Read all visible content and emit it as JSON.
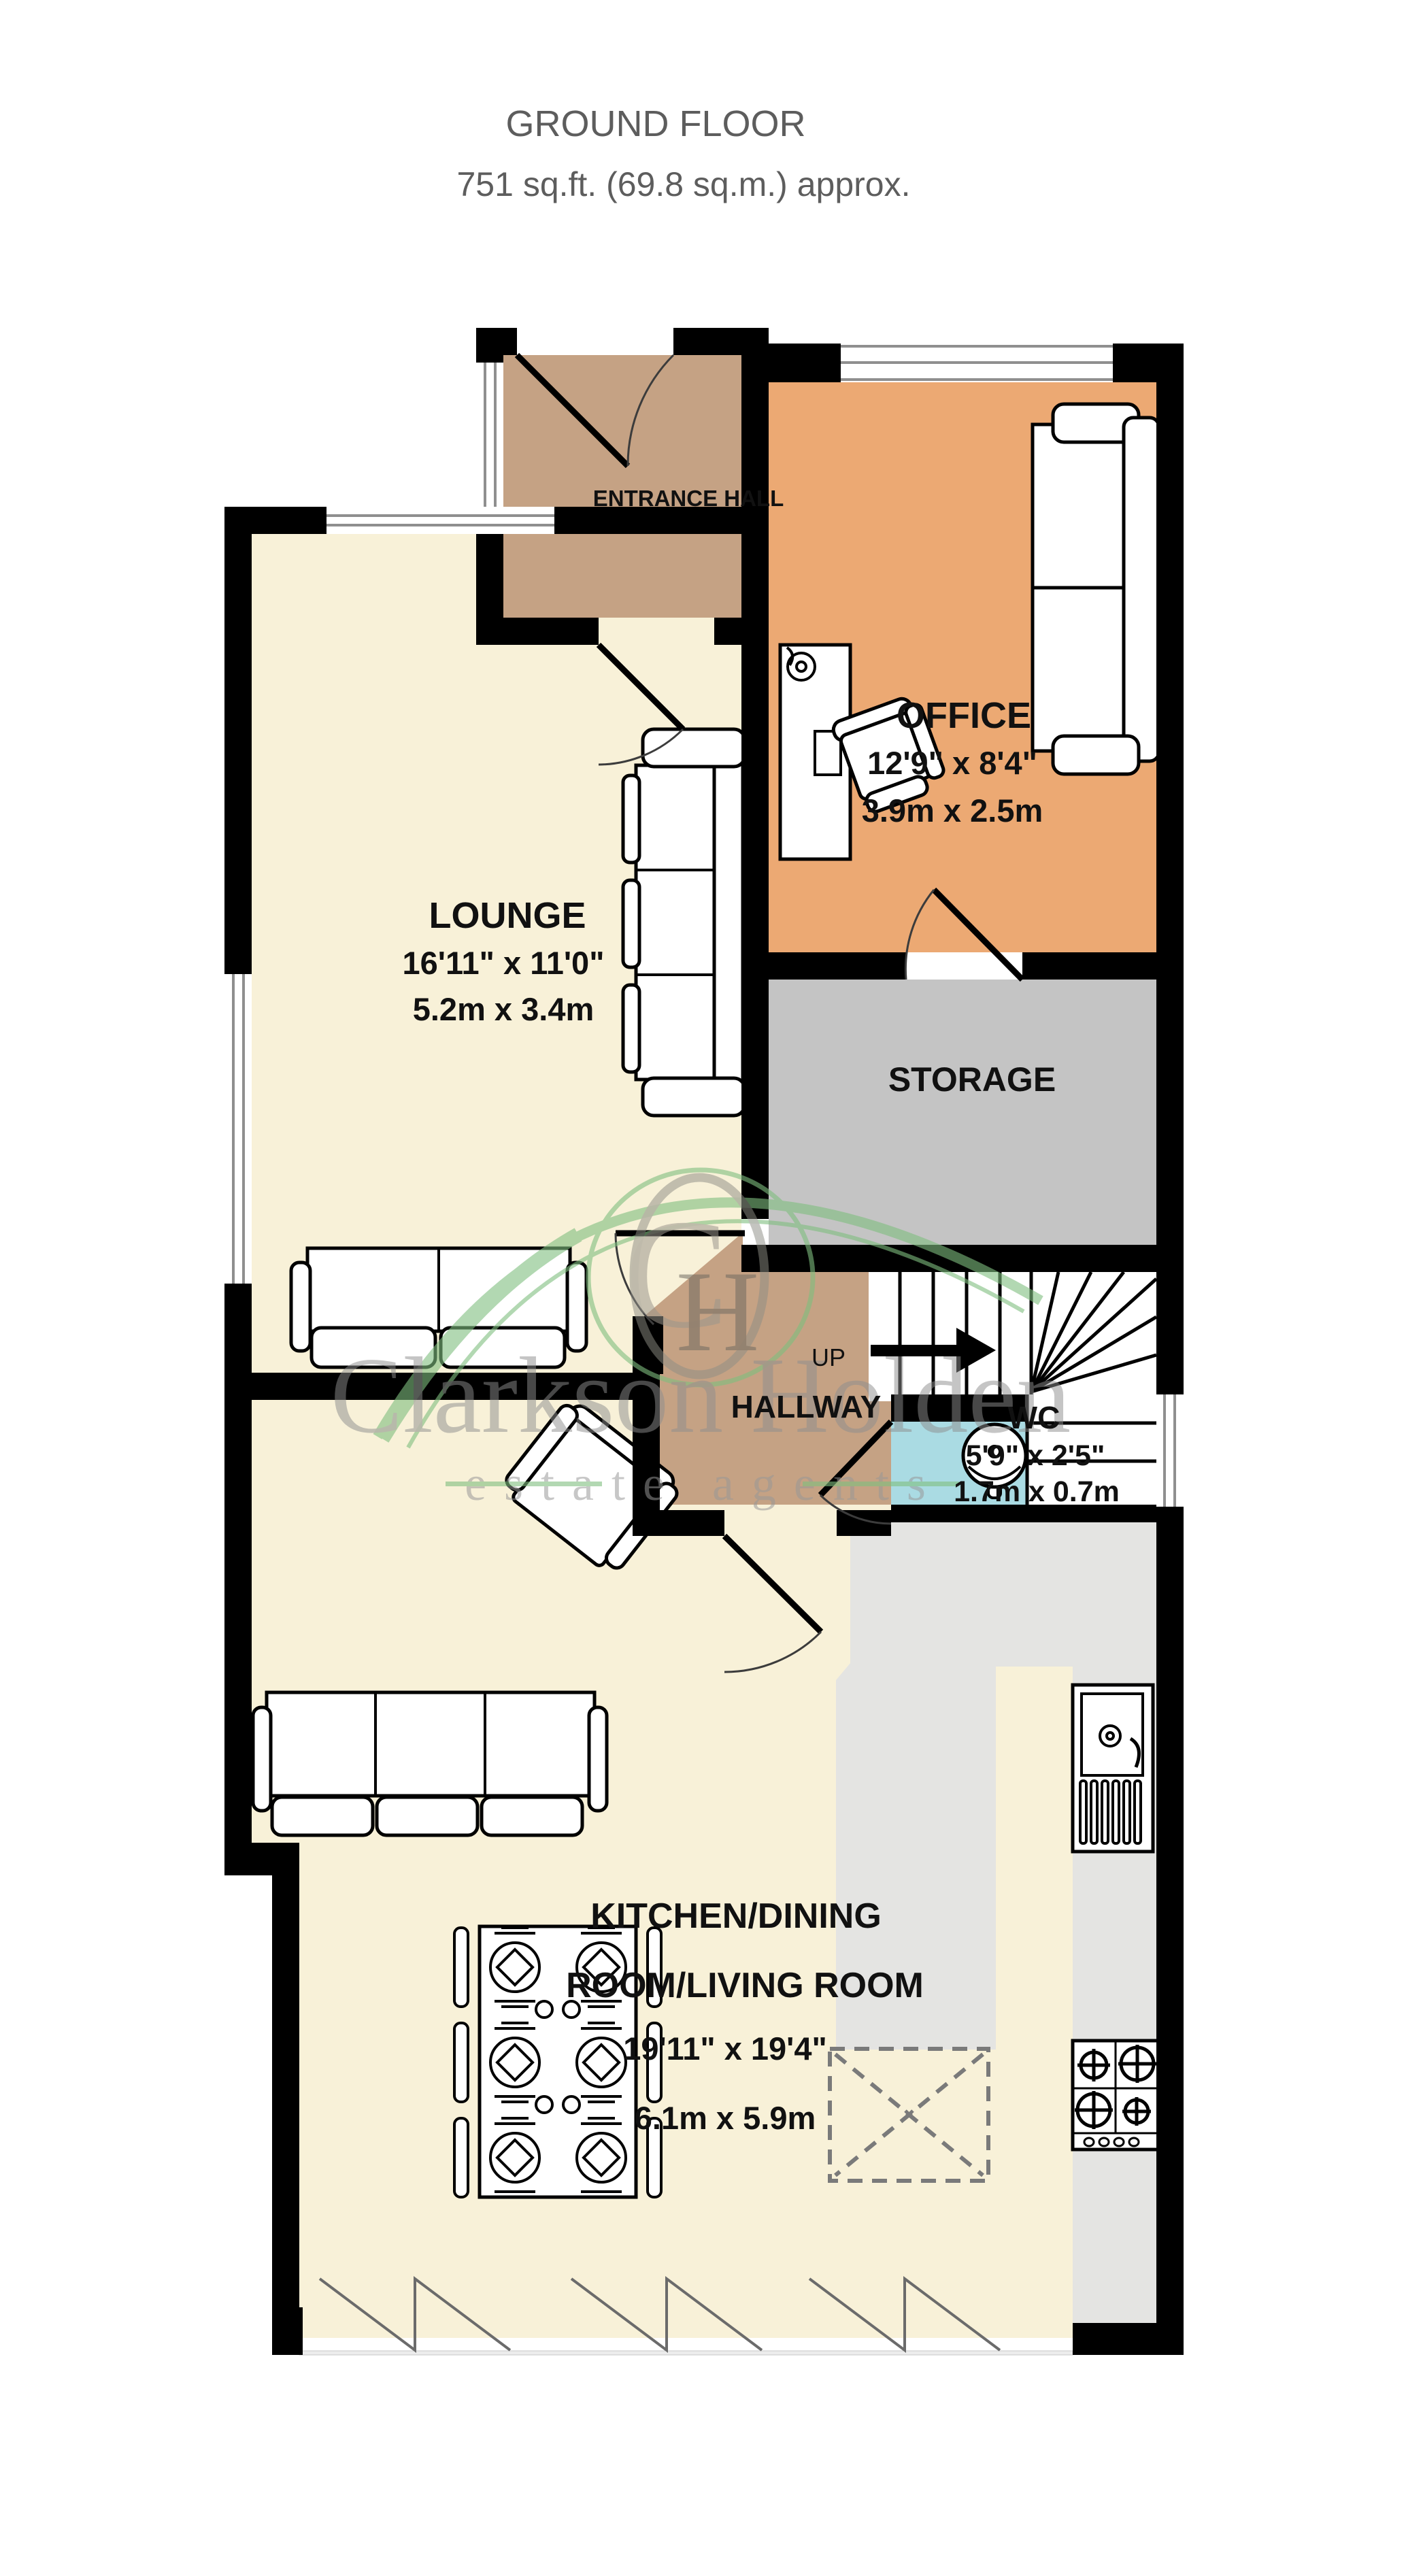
{
  "title": {
    "line1": "GROUND FLOOR",
    "line2": "751 sq.ft. (69.8 sq.m.) approx."
  },
  "rooms": {
    "entrance_hall": {
      "name": "ENTRANCE HALL"
    },
    "office": {
      "name": "OFFICE",
      "dims_imperial": "12'9\"  x 8'4\"",
      "dims_metric": "3.9m  x 2.5m"
    },
    "lounge": {
      "name": "LOUNGE",
      "dims_imperial": "16'11\"  x 11'0\"",
      "dims_metric": "5.2m  x 3.4m"
    },
    "storage": {
      "name": "STORAGE"
    },
    "hallway": {
      "name": "HALLWAY",
      "up_label": "UP"
    },
    "wc": {
      "name": "WC",
      "dims_imperial": "5'9\"  x 2'5\"",
      "dims_metric": "1.7m  x 0.7m"
    },
    "kitchen": {
      "name_line1": "KITCHEN/DINING",
      "name_line2": "ROOM/LIVING ROOM",
      "dims_imperial": "19'11\"  x 19'4\"",
      "dims_metric": "6.1m  x 5.9m"
    }
  },
  "watermark": {
    "name": "Clarkson Holden",
    "tagline": "estate agents",
    "initial_c": "C",
    "initial_h": "H"
  },
  "colors": {
    "wall": "#000000",
    "cream": "#f8f1d8",
    "tan": "#c5a284",
    "orange": "#eca973",
    "storage_gray": "#c4c4c4",
    "wc_blue": "#aadbe3",
    "floor_gray": "#e4e4e2",
    "watermark_green": "#7fbf7f",
    "watermark_gray": "#8f8f8f",
    "title_gray": "#5d5d5d"
  }
}
